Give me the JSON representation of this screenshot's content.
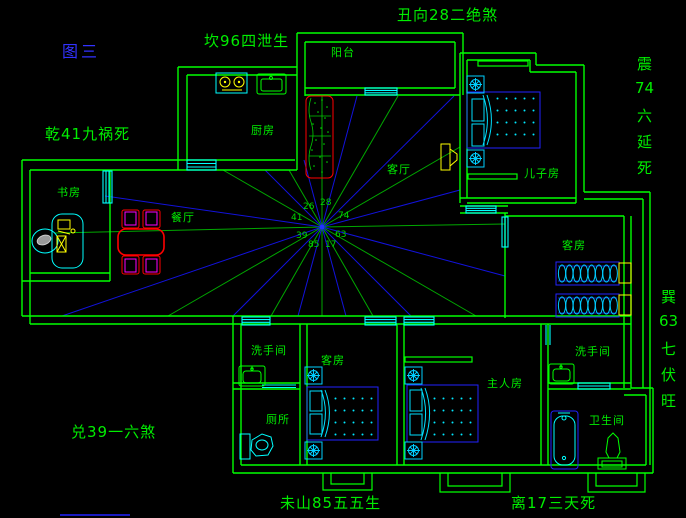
{
  "figure_label": "图三",
  "annotations": {
    "top": "丑向28二绝煞",
    "upper_left": "坎96四泄生",
    "left": "乾41九祸死",
    "right_upper": [
      "震",
      "74",
      "六",
      "延",
      "死"
    ],
    "right_lower": [
      "巽",
      "63",
      "七",
      "伏",
      "旺"
    ],
    "bottom_left": "兑39一六煞",
    "bottom_center": "未山85五五生",
    "bottom_right": "离17三天死"
  },
  "rooms": {
    "balcony": "阳台",
    "kitchen": "厨房",
    "living_room": "客厅",
    "sons_room": "儿子房",
    "study": "书房",
    "dining_room": "餐厅",
    "guest_room_east": "客房",
    "washroom_west": "洗手间",
    "toilet": "厕所",
    "guest_room_south": "客房",
    "master_room": "主人房",
    "washroom_east": "洗手间",
    "bathroom": "卫生间"
  },
  "compass_numbers": {
    "upper_left": "26",
    "top": "28",
    "left": "41",
    "right": "74",
    "lower_left": "39",
    "lower_right": "63",
    "bottom": "85",
    "bottom_right": "17"
  },
  "colors": {
    "background": "#000000",
    "wall_green": "#00ff00",
    "ray_green": "#00a800",
    "ray_blue": "#1212dc",
    "furniture_blue": "#2222ff",
    "detail_cyan": "#00ffff",
    "accent_yellow": "#ffff00",
    "accent_red": "#ff0000",
    "accent_magenta": "#ff00ff",
    "title_blue": "#3232ff",
    "label_green": "#00ee00"
  }
}
